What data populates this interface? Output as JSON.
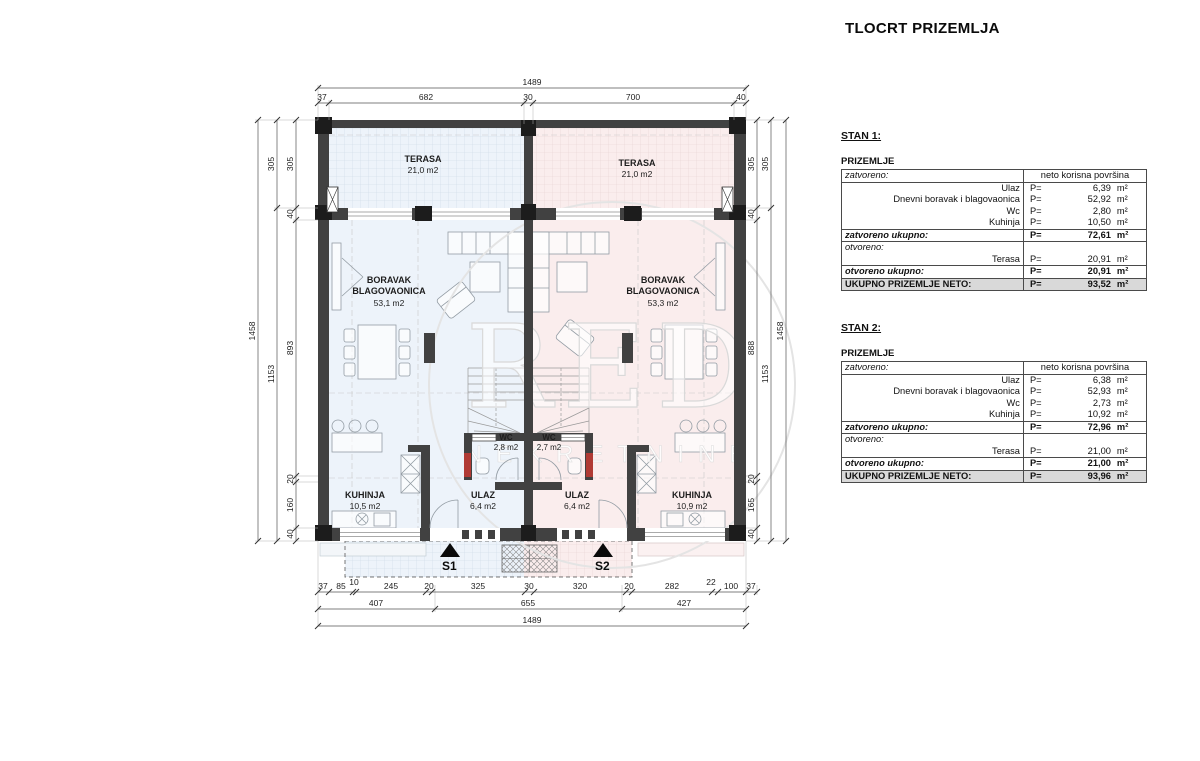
{
  "title": "TLOCRT PRIZEMLJA",
  "watermark": {
    "big": "RED",
    "small": "NEKRETNINE"
  },
  "colors": {
    "unit_left": "#edf3fa",
    "unit_right": "#faeded",
    "wall": "#414141",
    "red_jamb": "#b03a34",
    "total_row_bg": "#d9d9d9"
  },
  "plan": {
    "rooms": {
      "terasa_l": {
        "name": "TERASA",
        "area": "21,0 m2"
      },
      "terasa_r": {
        "name": "TERASA",
        "area": "21,0 m2"
      },
      "boravak_l": {
        "name1": "BORAVAK",
        "name2": "BLAGOVAONICA",
        "area": "53,1 m2"
      },
      "boravak_r": {
        "name1": "BORAVAK",
        "name2": "BLAGOVAONICA",
        "area": "53,3 m2"
      },
      "wc_l": {
        "name": "WC",
        "area": "2,8 m2"
      },
      "wc_r": {
        "name": "WC",
        "area": "2,7 m2"
      },
      "ulaz_l": {
        "name": "ULAZ",
        "area": "6,4 m2"
      },
      "ulaz_r": {
        "name": "ULAZ",
        "area": "6,4 m2"
      },
      "kuhinja_l": {
        "name": "KUHINJA",
        "area": "10,5 m2"
      },
      "kuhinja_r": {
        "name": "KUHINJA",
        "area": "10,9 m2"
      }
    },
    "markers": {
      "s1": "S1",
      "s2": "S2"
    },
    "dims": {
      "top_total": "1489",
      "top": [
        "37",
        "682",
        "30",
        "700",
        "40"
      ],
      "left_outer": "1458",
      "left_mid": [
        "305",
        "1153"
      ],
      "left_inner": [
        "305",
        "40",
        "893",
        "20",
        "160",
        "40"
      ],
      "right_outer": "1458",
      "right_mid": [
        "305",
        "1153"
      ],
      "right_inner": [
        "305",
        "40",
        "888",
        "20",
        "165",
        "40"
      ],
      "bottom1": [
        "37",
        "85",
        "10",
        "245",
        "20",
        "325",
        "30",
        "320",
        "20",
        "282",
        "22",
        "100",
        "37"
      ],
      "bottom2": [
        "407",
        "655",
        "427"
      ],
      "bottom_total": "1489"
    }
  },
  "tables": [
    {
      "title": "STAN 1:",
      "floor": "PRIZEMLJE",
      "closed_label": "zatvoreno:",
      "header_right": "neto korisna površina",
      "rows_closed": [
        [
          "Ulaz",
          "P=",
          "6,39",
          "m²"
        ],
        [
          "Dnevni boravak i blagovaonica",
          "P=",
          "52,92",
          "m²"
        ],
        [
          "Wc",
          "P=",
          "2,80",
          "m²"
        ],
        [
          "Kuhinja",
          "P=",
          "10,50",
          "m²"
        ]
      ],
      "closed_total": {
        "label": "zatvoreno ukupno:",
        "p": "P=",
        "value": "72,61",
        "unit": "m²"
      },
      "open_label": "otvoreno:",
      "rows_open": [
        [
          "Terasa",
          "P=",
          "20,91",
          "m²"
        ]
      ],
      "open_total": {
        "label": "otvoreno ukupno:",
        "p": "P=",
        "value": "20,91",
        "unit": "m²"
      },
      "grand_total": {
        "label": "UKUPNO  PRIZEMLJE NETO:",
        "p": "P=",
        "value": "93,52",
        "unit": "m²"
      }
    },
    {
      "title": "STAN 2:",
      "floor": "PRIZEMLJE",
      "closed_label": "zatvoreno:",
      "header_right": "neto korisna površina",
      "rows_closed": [
        [
          "Ulaz",
          "P=",
          "6,38",
          "m²"
        ],
        [
          "Dnevni boravak i blagovaonica",
          "P=",
          "52,93",
          "m²"
        ],
        [
          "Wc",
          "P=",
          "2,73",
          "m²"
        ],
        [
          "Kuhinja",
          "P=",
          "10,92",
          "m²"
        ]
      ],
      "closed_total": {
        "label": "zatvoreno ukupno:",
        "p": "P=",
        "value": "72,96",
        "unit": "m²"
      },
      "open_label": "otvoreno:",
      "rows_open": [
        [
          "Terasa",
          "P=",
          "21,00",
          "m²"
        ]
      ],
      "open_total": {
        "label": "otvoreno ukupno:",
        "p": "P=",
        "value": "21,00",
        "unit": "m²"
      },
      "grand_total": {
        "label": "UKUPNO  PRIZEMLJE NETO:",
        "p": "P=",
        "value": "93,96",
        "unit": "m²"
      }
    }
  ]
}
